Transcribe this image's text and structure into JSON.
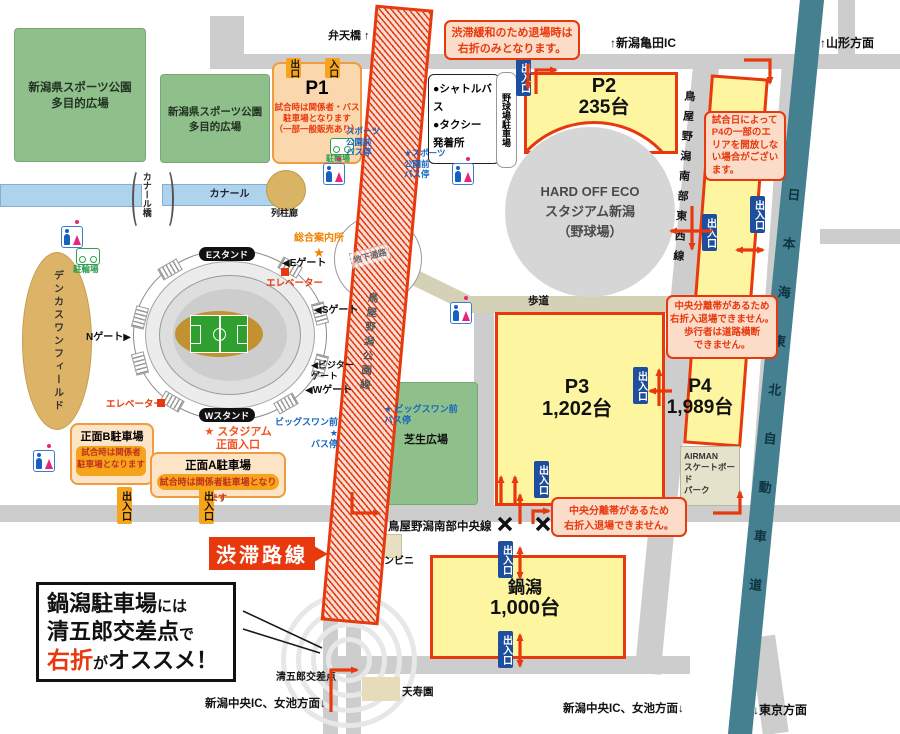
{
  "symbols": {
    "star": "★"
  },
  "areas": {
    "sports_park_a": "新潟県スポーツ公園\n多目的広場",
    "sports_park_b": "新潟県スポーツ公園\n多目的広場",
    "lawn_plaza": "芝生広場",
    "denka_swan_field": "デンカスワンフィールド",
    "baseball_stadium": "HARD OFF ECO\nスタジアム新潟\n（野球場）",
    "baseball_parking": "野球場駐車場",
    "shuttle_taxi": "●シャトルバス\n●タクシー\n発着所",
    "airman_skatepark": "AIRMAN\nスケートボード\nパーク",
    "tenjuen": "天寿園",
    "convenience_store": "コンビニ",
    "colonnade": "列柱廊",
    "canal": "カナール",
    "canal_bridge": "カナール橋",
    "underground_passage": "地下通路",
    "sidewalk": "歩道"
  },
  "parkings": {
    "gate_badge": "出入口",
    "p1": {
      "name": "P1",
      "exit": "出口",
      "entrance": "入口",
      "note": "試合時は関係者・バス\n駐車場となります\n（一部一般販売あり）",
      "bicycle": "駐輪場"
    },
    "p2": {
      "name": "P2",
      "capacity": "235台"
    },
    "p3": {
      "name": "P3",
      "capacity": "1,202台"
    },
    "p4": {
      "name": "P4",
      "capacity": "1,989台"
    },
    "nabegata": {
      "name": "鍋潟",
      "capacity": "1,000台"
    },
    "front_a": {
      "name": "正面A駐車場",
      "note": "試合時は関係者駐車場となります"
    },
    "front_b": {
      "name": "正面B駐車場",
      "note": "試合時は関係者\n駐車場となります"
    }
  },
  "stadium": {
    "e_stand": "Eスタンド",
    "w_stand": "Wスタンド",
    "gate_e": "◀Eゲート",
    "gate_s": "◀Sゲート",
    "gate_w": "◀Wゲート",
    "gate_n": "Nゲート▶",
    "gate_visitor": "◀ビジター\nゲート",
    "elevator_top": "エレベーター",
    "elevator_bottom": "エレベーター",
    "info_center": "総合案内所",
    "front_entrance": "★ スタジアム\n正面入口"
  },
  "bus_stops": {
    "sports_park_left": "スポーツ\n公園前\nバス停",
    "sports_park_right": "★スポーツ\n公園前\nバス停",
    "big_swan_left": "ビッグスワン前 ★\nバス停",
    "big_swan_right": "★ ビッグスワン前\nバス停"
  },
  "roads": {
    "toyanogata_park_line": "鳥屋野潟公園線",
    "toyanogata_south_central": "鳥屋野潟南部中央線",
    "toyanogata_south_eastwest": "鳥屋野潟南部東西線",
    "nihonkai_tohoku_expressway": "日本海東北自動車道",
    "benten_bridge": "弁天橋 ↑"
  },
  "directions": {
    "niigata_kameda_ic": "↑新潟亀田IC",
    "yamagata": "↑山形方面",
    "tokyo": "↓東京方面",
    "niigata_chuo_ic_west": "新潟中央IC、女池方面↓",
    "niigata_chuo_ic_east": "新潟中央IC、女池方面↓"
  },
  "notes": {
    "right_turn_only": "渋滞緩和のため退場時は\n右折のみとなります。",
    "p4_partial_close": "試合日によって\nP4の一部のエ\nリアを開放しな\nい場合がござい\nます。",
    "median_no_right_pedestrian": "中央分離帯があるため\n右折入退場できません。\n歩行者は道路横断\nできません。",
    "median_no_right": "中央分離帯があるため\n右折入退場できません。"
  },
  "facilities": {
    "bicycle_parking": "駐輪場"
  },
  "callouts": {
    "congestion_route": "渋滞路線",
    "bubble": {
      "l1_big": "鍋潟駐車場",
      "l1_small": "には",
      "l2_big": "清五郎交差点",
      "l2_small": "で",
      "l3_red": "右折",
      "l3_small": "が",
      "l3_big": "オススメ！"
    },
    "seigoro_intersection": "清五郎交差点"
  },
  "colors": {
    "accent_red": "#e8380d",
    "parking_yellow": "#fdf5a0",
    "badge_blue": "#1d4f9e",
    "badge_orange": "#f6a41c",
    "expressway_teal": "#44808f",
    "park_green": "#8fc08b",
    "field_tan": "#ddb368",
    "road_gray": "#cdcdcd"
  }
}
